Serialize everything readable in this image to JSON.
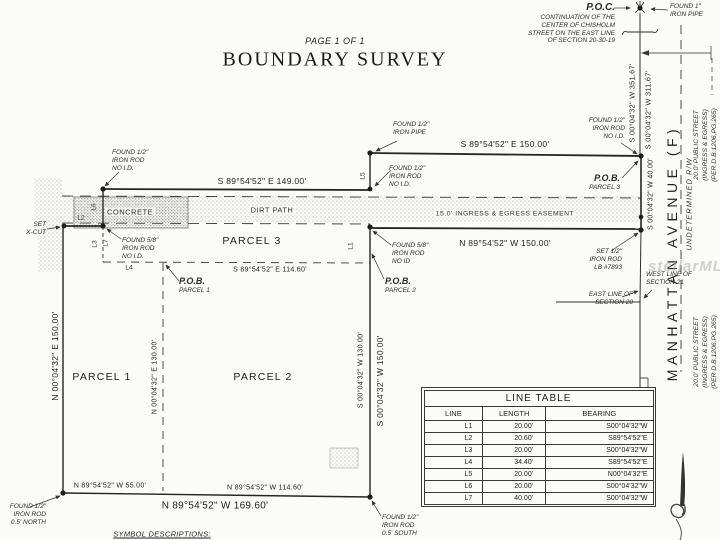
{
  "page": {
    "label": "PAGE 1 OF 1",
    "title": "BOUNDARY SURVEY",
    "watermark": "stellarMLS",
    "symbol_descriptions": "SYMBOL DESCRIPTIONS:"
  },
  "poc": {
    "title": "P.O.C.",
    "line1": "CONTINUATION OF THE",
    "line2": "CENTER OF CHISHOLM",
    "line3": "STREET ON THE EAST LINE",
    "line4": "OF SECTION 20-30-19"
  },
  "markers": {
    "found_1_pipe": [
      "FOUND 1\"",
      "IRON PIPE"
    ],
    "found_half_pipe": [
      "FOUND 1/2\"",
      "IRON PIPE"
    ],
    "found_half_rod_mid": [
      "FOUND 1/2\"",
      "IRON ROD",
      "NO I.D."
    ],
    "found_half_rod_tr": [
      "FOUND 1/2\"",
      "IRON ROD",
      "NO I.D."
    ],
    "found_half_rod_left": [
      "FOUND 1/2\"",
      "IRON ROD",
      "NO I.D."
    ],
    "found_58_rod_1": [
      "FOUND 5/8\"",
      "IRON ROD",
      "NO I.D."
    ],
    "found_58_rod_2": [
      "FOUND 5/8\"",
      "IRON ROD",
      "NO ID"
    ],
    "set_x_cut": [
      "SET",
      "X-CUT"
    ],
    "set_half_rod": [
      "SET 1/2\"",
      "IRON ROD",
      "LB #7893"
    ],
    "found_bl": [
      "FOUND 1/2\"",
      "IRON ROD",
      "0.5' NORTH"
    ],
    "found_br": [
      "FOUND 1/2\"",
      "IRON ROD",
      "0.5' SOUTH"
    ]
  },
  "pob": {
    "p1": [
      "P.O.B.",
      "PARCEL 1"
    ],
    "p2": [
      "P.O.B.",
      "PARCEL 2"
    ],
    "p3": [
      "P.O.B.",
      "PARCEL 3"
    ]
  },
  "parcels": {
    "p1": "PARCEL 1",
    "p2": "PARCEL 2",
    "p3": "PARCEL 3"
  },
  "areas": {
    "concrete": "CONCRETE",
    "dirt_path": "DIRT PATH",
    "easement": "15.0' INGRESS & EGRESS EASEMENT"
  },
  "dims": {
    "top150": "S 89°54'52\" E 150.00'",
    "top149": "S 89°54'52\" E 149.00'",
    "mid11460": "S 89°54'52\" E 114.60'",
    "n150": "N 89°54'52\" W 150.00'",
    "w40": "S 00°04'32\" W 40.00'",
    "w35167": "S 00°04'32\" W 351.67'",
    "w31167": "S 00°04'32\" W 311.67'",
    "e150": "N 00°04'32\" E 150.00'",
    "e130": "N 00°04'32\" E 130.00'",
    "w130": "S 00°04'32\" W 130.00'",
    "w150": "S 00°04'32\" W 150.00'",
    "b55": "N 89°54'52\" W 55.00'",
    "b11460": "N 89°54'52\" W 114.60'",
    "b16960": "N 89°54'52\" W 169.60'"
  },
  "street": {
    "name": "MANHATTAN AVENUE (F)",
    "rw": "UNDETERMINED R/W",
    "public": [
      "20.0' PUBLIC STREET",
      "(INGRESS & EGRESS)",
      "(PER D.B.1206,PG.265)"
    ],
    "west_line": [
      "WEST LINE OF",
      "SECTION 21"
    ],
    "east_line": [
      "EAST LINE OF",
      "SECTION 20"
    ]
  },
  "line_labels": {
    "l1": "L1",
    "l2": "L2",
    "l3": "L3",
    "l4": "L4",
    "l5": "L5",
    "l6": "L6",
    "l7": "L7"
  },
  "line_table": {
    "title": "LINE TABLE",
    "headers": [
      "LINE",
      "LENGTH",
      "BEARING"
    ],
    "rows": [
      [
        "L1",
        "20.00'",
        "S00°04'32\"W"
      ],
      [
        "L2",
        "20.60'",
        "S89°54'52\"E"
      ],
      [
        "L3",
        "20.00'",
        "S00°04'32\"W"
      ],
      [
        "L4",
        "34.40'",
        "S89°54'52\"E"
      ],
      [
        "L5",
        "20.00'",
        "N00°04'32\"E"
      ],
      [
        "L6",
        "20.00'",
        "S00°04'32\"W"
      ],
      [
        "L7",
        "40.00'",
        "S00°04'32\"W"
      ]
    ]
  }
}
